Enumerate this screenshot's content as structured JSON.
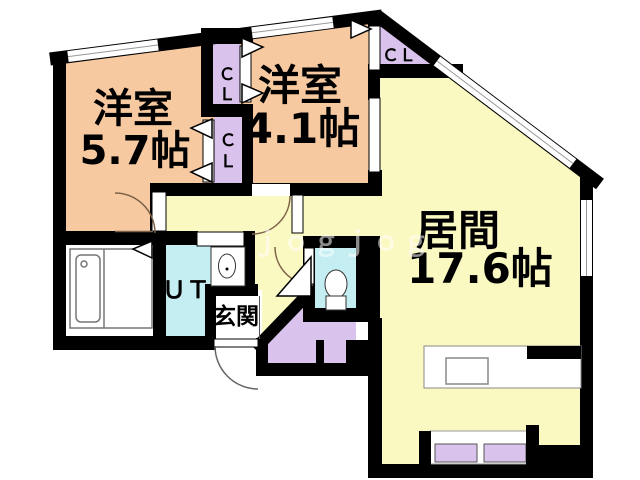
{
  "plan": {
    "rooms": {
      "bedroom1": {
        "name": "洋室",
        "size": "5.7帖"
      },
      "bedroom2": {
        "name": "洋室",
        "size": "4.1帖"
      },
      "living": {
        "name": "居間",
        "size": "17.6帖"
      },
      "utility": {
        "label": "ＵＴ"
      },
      "entrance": {
        "label": "玄関"
      },
      "closet_upper": {
        "char1": "Ｃ",
        "char2": "Ｌ"
      },
      "closet_lower": {
        "char1": "Ｃ",
        "char2": "Ｌ"
      },
      "closet_corner": {
        "label": "ＣＬ"
      }
    },
    "watermark": {
      "text": "ｊｏｇｊｏｇ"
    },
    "colors": {
      "wall": "#000000",
      "bedroom_fill": "#f6c9a0",
      "living_fill": "#fbf9c2",
      "closet_fill": "#d9c2ec",
      "water_fill": "#c4eef2",
      "floor_white": "#ffffff"
    }
  }
}
